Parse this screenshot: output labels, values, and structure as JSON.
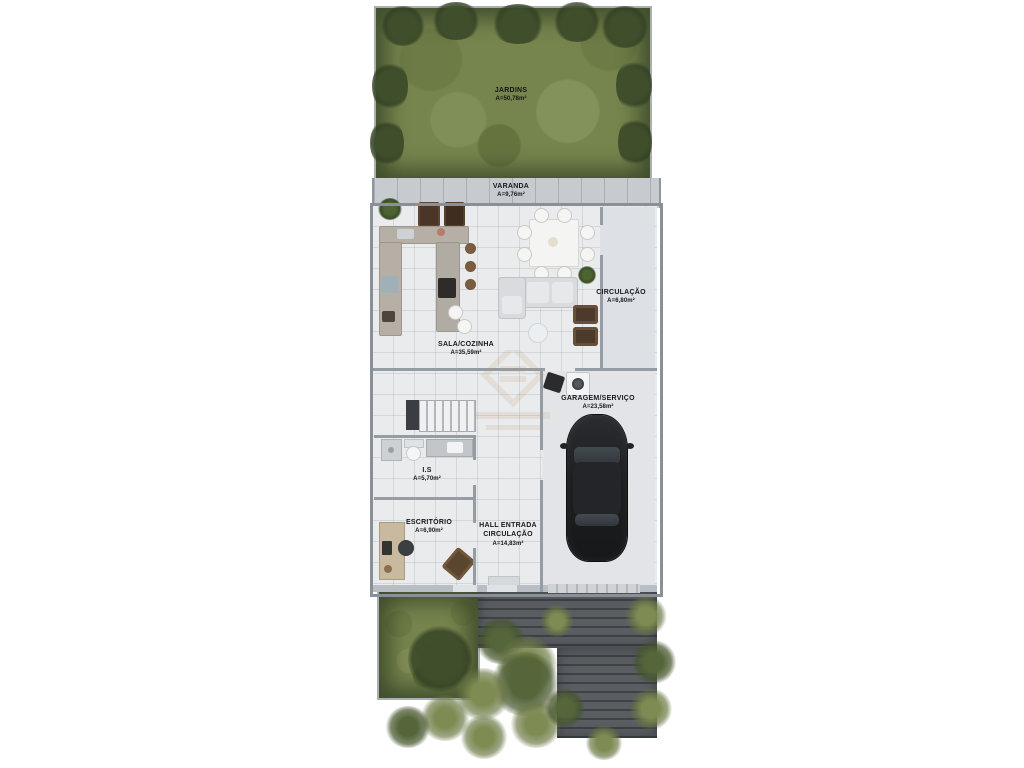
{
  "rooms": {
    "jardins": {
      "name": "JARDINS",
      "area": "A=50,78m²"
    },
    "varanda": {
      "name": "VARANDA",
      "area": "A=9,76m²"
    },
    "sala": {
      "name": "SALA/COZINHA",
      "area": "A=35,59m²"
    },
    "circulacao": {
      "name": "CIRCULAÇÃO",
      "area": "A=6,80m²"
    },
    "garagem": {
      "name": "GARAGEM/SERVIÇO",
      "area": "A=23,58m²"
    },
    "is": {
      "name": "I.S",
      "area": "A=5,70m²"
    },
    "escritorio": {
      "name": "ESCRITÓRIO",
      "area": "A=6,90m²"
    },
    "hall": {
      "name": "HALL ENTRADA",
      "name2": "CIRCULAÇÃO",
      "area": "A=14,83m²"
    }
  },
  "colors": {
    "grass": "#76854e",
    "bush": "#3f4f2c",
    "wall": "#969ca4",
    "floor": "#e9ebed",
    "varanda_tile": "#c7cbd0",
    "counter": "#b6afa5",
    "car": "#1c1e20",
    "wood_brown": "#4c3b2b",
    "driveway": "#4a4e52",
    "label_text": "#17181a",
    "watermark_gold": "#b78e4a"
  }
}
